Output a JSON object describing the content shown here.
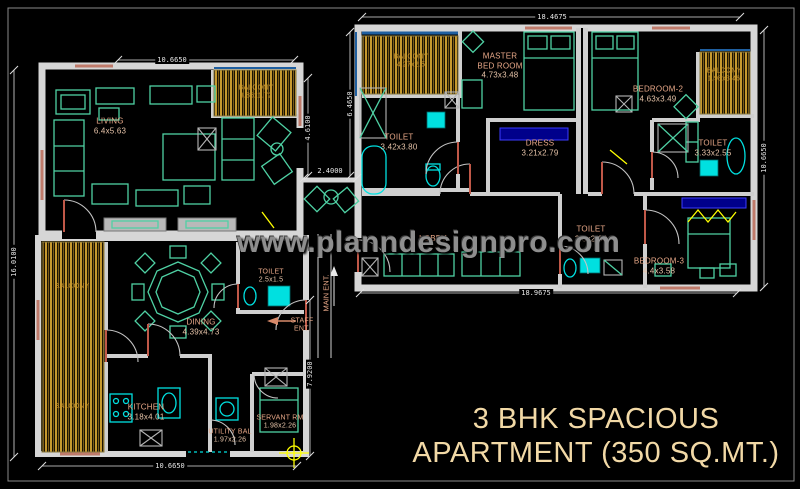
{
  "drawing_title": {
    "line1": "3 BHK SPACIOUS",
    "line2": "APARTMENT (350 SQ.MT.)"
  },
  "watermark": {
    "text": "www.planndesignpro.com"
  },
  "rooms": {
    "living": {
      "name": "LIVING",
      "size": "6.4x5.63"
    },
    "living_balcony": {
      "name": "BALCONY",
      "size": "3.86x1.72"
    },
    "master_balcony": {
      "name": "BALCONY",
      "size": "4.27x2.5"
    },
    "master_bedroom": {
      "name": "MASTER BED ROOM",
      "size": "4.73x3.48"
    },
    "master_toilet": {
      "name": "TOILET",
      "size": "3.42x3.80"
    },
    "dress": {
      "name": "DRESS",
      "size": "3.21x2.79"
    },
    "bedroom2": {
      "name": "BEDROOM-2",
      "size": "4.63x3.49"
    },
    "bedroom2_balcony": {
      "name": "BALCONY",
      "size": "1.98x3.46"
    },
    "bedroom2_toilet": {
      "name": "TOILET",
      "size": "3.33x2.55"
    },
    "lobby": {
      "name": "LOBBY"
    },
    "bedroom3_toilet": {
      "name": "TOILET",
      "size": "2.8x2.03"
    },
    "bedroom3": {
      "name": "BEDROOM-3",
      "size": "4.4x3.58"
    },
    "side_balcony_upper": {
      "name": "BALCONY"
    },
    "side_balcony_lower": {
      "name": "BALCONY"
    },
    "dining": {
      "name": "DINING",
      "size": "4.39x4.73"
    },
    "dining_toilet": {
      "name": "TOILET",
      "size": "2.5x1.5"
    },
    "kitchen": {
      "name": "KITCHEN",
      "size": "3.18x4.01"
    },
    "utility_balcony": {
      "name": "UTILITY BAL",
      "size": "1.97x2.26"
    },
    "servant_room": {
      "name": "SERVANT RM",
      "size": "1.98x2.26"
    }
  },
  "entrances": {
    "main": "MAIN ENT.",
    "staff": "STAFF ENT."
  },
  "dimensions": {
    "upper_block_width": "18.4675",
    "living_width": "10.6650",
    "living_right_height": "4.6100",
    "passage_width": "2.4000",
    "upper_block_left_height": "6.4650",
    "upper_block_right_height": "10.6650",
    "upper_block_bottom_width": "18.9675",
    "left_total_height": "16.0100",
    "lower_block_width": "10.6650",
    "lower_block_right_height": "7.9200"
  },
  "colors": {
    "background": "#000000",
    "wall": "#d6d6d6",
    "furniture_teal": "#4fd1a4",
    "fixture_cyan": "#00e0e0",
    "balcony_gold": "#c79a2f",
    "label_text": "#e8a888",
    "dimension_text": "#e6e6e6",
    "wardrobe_blue": "#00008b",
    "accent_yellow": "#ffff00",
    "door_red": "#c05848",
    "title_text": "#f2d9a6",
    "watermark_text": "#8e8e8e"
  }
}
